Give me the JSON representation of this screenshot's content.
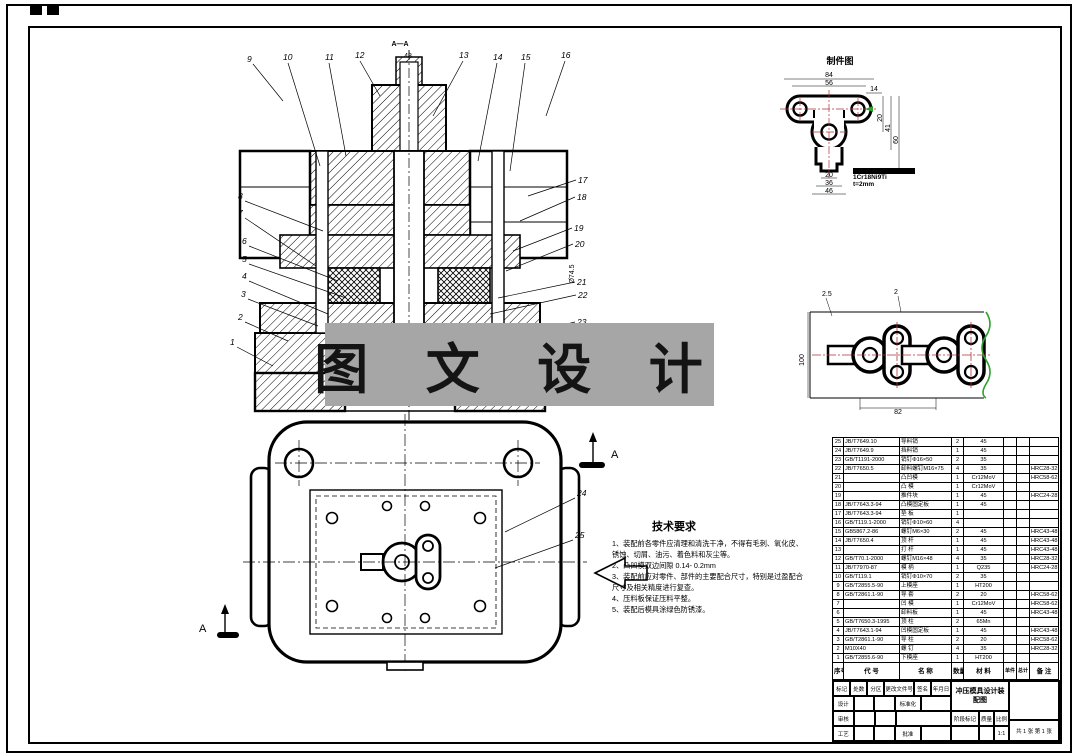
{
  "colors": {
    "line": "#000000",
    "centerline": "#b03434",
    "break_green": "#2da12d",
    "watermark_bg": "#a6a6a6"
  },
  "watermark": {
    "text": "图 文 设 计"
  },
  "main_view": {
    "section_label": "A—A",
    "dims": {
      "shank_top": "48",
      "right_dia": "Ø74.5"
    },
    "balloons_top": [
      "9",
      "10",
      "11",
      "12",
      "13",
      "14",
      "15",
      "16"
    ],
    "balloons_left": [
      "8",
      "7",
      "6",
      "5",
      "4",
      "3",
      "2",
      "1"
    ],
    "balloons_right": [
      "17",
      "18",
      "19",
      "20",
      "21",
      "22",
      "23"
    ]
  },
  "plan_view": {
    "balloons": [
      "24",
      "25"
    ],
    "arrow_label_top": "A",
    "arrow_label_bottom": "A"
  },
  "workpiece_view": {
    "label": "制件图",
    "dims": {
      "top1": "84",
      "top2": "56",
      "top3": "14",
      "right1": "20",
      "right2": "41",
      "right3": "60",
      "bot1": "20",
      "bot2": "36",
      "bot3": "46"
    },
    "note_material": "1Cr18Ni9Ti",
    "note_thickness": "t=2mm"
  },
  "strip_view": {
    "dims": {
      "top1": "2.5",
      "top2": "2",
      "left": "100",
      "bottom": "82"
    }
  },
  "tech_req": {
    "title": "技术要求",
    "items": [
      "1、装配前各零件应清理和清洗干净，不得有毛刺、氧化皮、锈蚀、切屑、油污、着色料和灰尘等。",
      "2、凸凹模双边间隙  0.14- 0.2mm",
      "3、装配前应对零件、部件的主要配合尺寸，特别是过盈配合尺寸及相关精度进行复查。",
      "4、压料板保证压料平整。",
      "5、装配后模具涂绿色防锈漆。"
    ]
  },
  "parts_table": {
    "headers": {
      "no": "序号",
      "code": "代 号",
      "name": "名 称",
      "qty": "数量",
      "material": "材 料",
      "per": "单件",
      "total": "总计",
      "note": "备 注"
    },
    "rows": [
      [
        "25",
        "JB/T7649.10",
        "导料销",
        "2",
        "45",
        "",
        "",
        ""
      ],
      [
        "24",
        "JB/T7649.9",
        "挡料销",
        "1",
        "45",
        "",
        "",
        ""
      ],
      [
        "23",
        "GB/T1191-2000",
        "销钉Φ16×50",
        "2",
        "35",
        "",
        "",
        ""
      ],
      [
        "22",
        "JB/T7650.5",
        "卸料螺钉M16×75",
        "4",
        "35",
        "",
        "",
        "HRC28-32"
      ],
      [
        "21",
        "",
        "凸凹模",
        "1",
        "Cr12MoV",
        "",
        "",
        "HRC58-62"
      ],
      [
        "20",
        "",
        "凸  模",
        "1",
        "Cr12MoV",
        "",
        "",
        ""
      ],
      [
        "19",
        "",
        "推件块",
        "1",
        "45",
        "",
        "",
        "HRC24-28"
      ],
      [
        "18",
        "JB/T7643.3-94",
        "凸模固定板",
        "1",
        "45",
        "",
        "",
        ""
      ],
      [
        "17",
        "JB/T7643.3-94",
        "垫  板",
        "1",
        "",
        "",
        "",
        ""
      ],
      [
        "16",
        "GB/T119.1-2000",
        "销钉Φ10×60",
        "4",
        "",
        "",
        "",
        ""
      ],
      [
        "15",
        "GB5867.2-86",
        "螺钉M6×30",
        "2",
        "45",
        "",
        "",
        "HRC43-48"
      ],
      [
        "14",
        "JB/T7650.4",
        "顶  杆",
        "1",
        "45",
        "",
        "",
        "HRC43-48"
      ],
      [
        "13",
        "",
        "打  杆",
        "1",
        "45",
        "",
        "",
        "HRC43-48"
      ],
      [
        "12",
        "GB/T70.1-2000",
        "螺钉M16×48",
        "4",
        "35",
        "",
        "",
        "HRC28-32"
      ],
      [
        "11",
        "JB/T7970-87",
        "模  柄",
        "1",
        "Q235",
        "",
        "",
        "HRC24-28"
      ],
      [
        "10",
        "GB/T119.1",
        "销钉Φ10×70",
        "2",
        "35",
        "",
        "",
        ""
      ],
      [
        "9",
        "GB/T2855.5-90",
        "上模座",
        "1",
        "HT200",
        "",
        "",
        ""
      ],
      [
        "8",
        "GB/T2861.1-90",
        "导  套",
        "2",
        "20",
        "",
        "",
        "HRC58-62"
      ],
      [
        "7",
        "",
        "凹  模",
        "1",
        "Cr12MoV",
        "",
        "",
        "HRC58-62"
      ],
      [
        "6",
        "",
        "卸料板",
        "1",
        "45",
        "",
        "",
        "HRC43-48"
      ],
      [
        "5",
        "GB/T7650.3-1995",
        "顶  柱",
        "2",
        "65Mn",
        "",
        "",
        ""
      ],
      [
        "4",
        "JB/T7643.1-94",
        "凹模固定板",
        "1",
        "45",
        "",
        "",
        "HRC43-48"
      ],
      [
        "3",
        "GB/T2861.1-90",
        "导  柱",
        "2",
        "20",
        "",
        "",
        "HRC58-62"
      ],
      [
        "2",
        "M10X40",
        "螺  钉",
        "4",
        "35",
        "",
        "",
        "HRC28-32"
      ],
      [
        "1",
        "GB/T2855.6-90",
        "下模座",
        "1",
        "HT200",
        "",
        "",
        ""
      ]
    ]
  },
  "title_block": {
    "title": "冲压模具设计装配图",
    "change_row": [
      "标记",
      "处数",
      "分区",
      "更改文件号",
      "签名",
      "年月日"
    ],
    "design": "设计",
    "check": "审核",
    "process": "工艺",
    "standard": "标准化",
    "approve": "批准",
    "stage": "阶段标记",
    "mass": "质量",
    "scale": "比例",
    "scale_value": "1:1",
    "sheet_info": "共 1 张  第 1 张"
  }
}
